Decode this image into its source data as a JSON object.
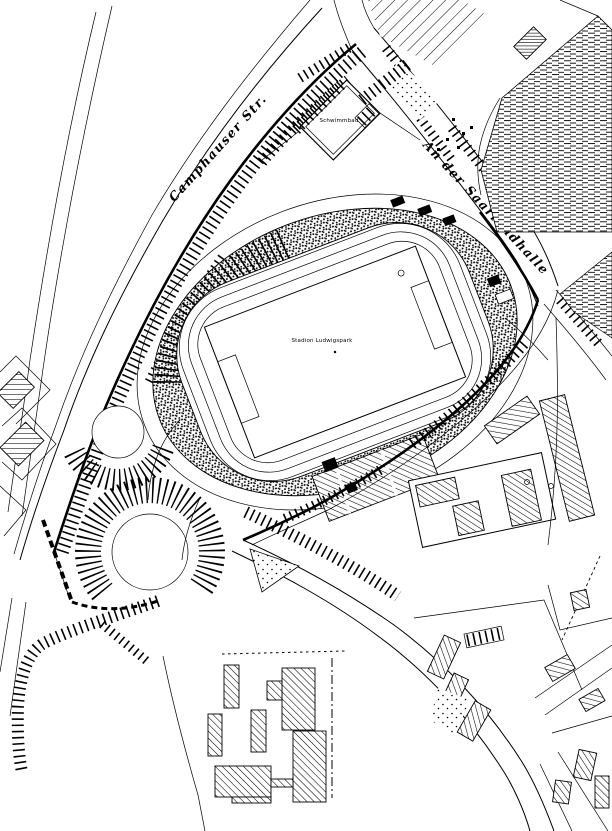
{
  "map": {
    "labels": {
      "street_west": "Camphauser Str.",
      "street_northeast": "An der Saarlandhalle",
      "stadium": "Stadion Ludwigspark",
      "north_building": "Schwimmbad"
    },
    "colors": {
      "ink": "#000000",
      "paper": "#ffffff"
    }
  }
}
